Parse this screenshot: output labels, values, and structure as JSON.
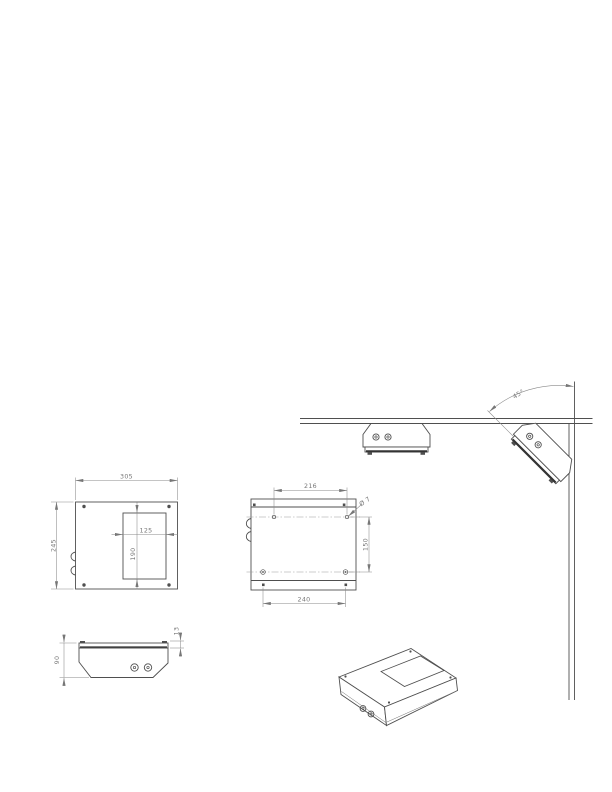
{
  "drawing": {
    "colors": {
      "outline": "#4f4f4f",
      "dimension_lines": "#8a8a8a",
      "label_text": "#777777"
    },
    "top_view": {
      "width": "305",
      "height": "245",
      "cutout_width": "125",
      "cutout_height": "190"
    },
    "mounting_view": {
      "upper_hole_spacing": "216",
      "lower_hole_spacing": "240",
      "vertical_hole_spacing": "150",
      "hole_diameter": "Ø 7"
    },
    "front_view": {
      "height": "90",
      "plate_thickness": "13"
    },
    "installation_view": {
      "mounting_angle": "45°"
    }
  }
}
